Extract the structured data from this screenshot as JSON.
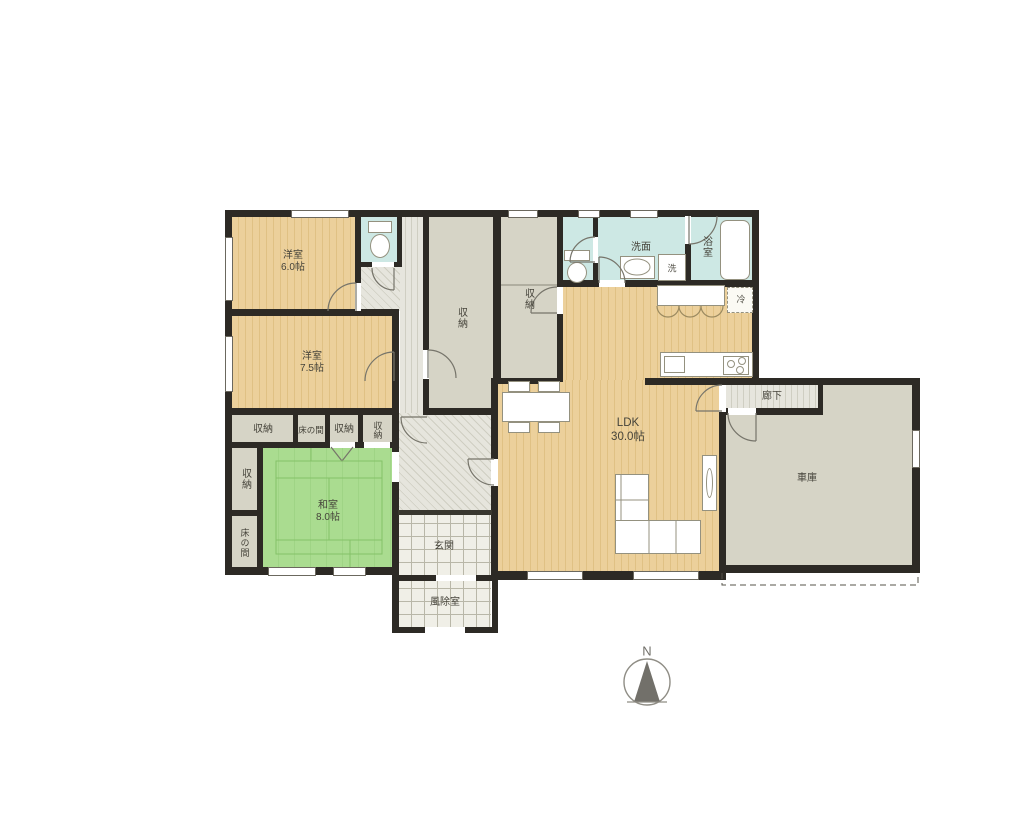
{
  "floorplan": {
    "rooms": {
      "yoshitsu6": {
        "name": "洋室",
        "size": "6.0帖"
      },
      "yoshitsu75": {
        "name": "洋室",
        "size": "7.5帖"
      },
      "washitsu": {
        "name": "和室",
        "size": "8.0帖"
      },
      "ldk": {
        "name": "LDK",
        "size": "30.0帖"
      },
      "genkan": {
        "name": "玄関"
      },
      "fujoshitsu": {
        "name": "風除室"
      },
      "senmen": {
        "name": "洗面"
      },
      "yokushitsu": {
        "name": "浴室"
      },
      "rouka": {
        "name": "廊下"
      },
      "shako": {
        "name": "車庫"
      },
      "shuno": {
        "name": "収納"
      },
      "tokonoma": {
        "name": "床の間"
      },
      "laundry": {
        "name": "洗"
      },
      "fridge": {
        "name": "冷"
      }
    },
    "compass": {
      "north": "N"
    },
    "colors": {
      "wood_floor": "#ecd09b",
      "tatami": "#aadc90",
      "storage": "#d6d4c6",
      "wet_area": "#cde8e4",
      "wall": "#2d2a25"
    }
  }
}
